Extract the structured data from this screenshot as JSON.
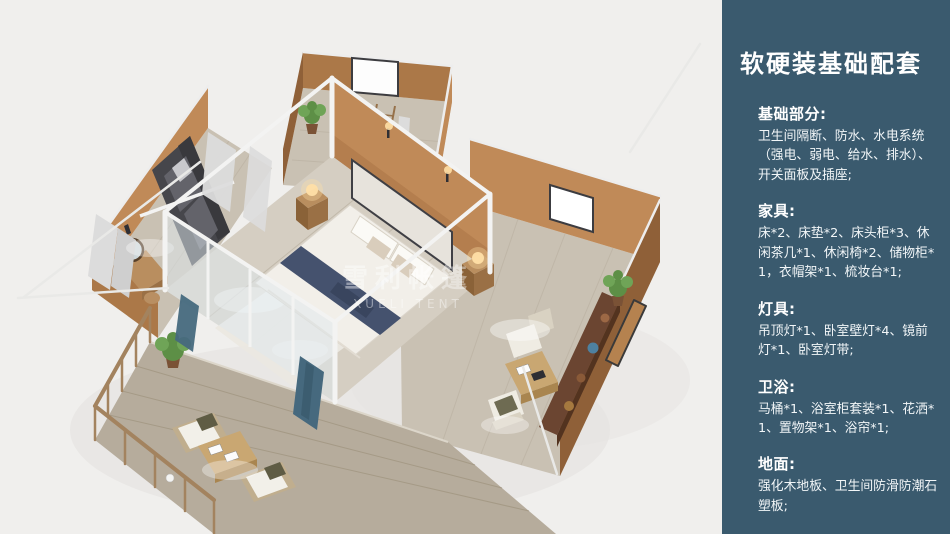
{
  "theme": {
    "canvas_bg": "#f0efed",
    "panel_bg": "#3a5a6e",
    "wall_lit": "#c08a58",
    "wall_mid": "#ab7848",
    "wall_dark": "#8f6038",
    "floor_wood": "#d5cec2",
    "floor_gray": "#c9c1b3",
    "deck_wood": "#b6ac9c",
    "rail_wood": "#a3835f",
    "frame_white": "#f3f3f2",
    "glass": "#dfe9ef",
    "bed_navy": "#45526e",
    "sofa_dark": "#46464b",
    "furn_wood": "#b98e5f",
    "sideboard": "#6b4531",
    "plant_green": "#5d8f46",
    "plant_green2": "#6fa457",
    "lamp_glow": "#ffdfa6",
    "curtain": "#dcdcdc",
    "blue_curtain": "#46697e"
  },
  "watermark": {
    "cn": "雪利帐篷",
    "en": "XUELI TENT"
  },
  "panel": {
    "title": "软硬装基础配套",
    "sections": [
      {
        "heading": "基础部分:",
        "body": "卫生间隔断、防水、水电系统（强电、弱电、给水、排水）、开关面板及插座;"
      },
      {
        "heading": "家具:",
        "body": "床*2、床垫*2、床头柜*3、休闲茶几*1、休闲椅*2、储物柜*1，衣帽架*1、梳妆台*1;"
      },
      {
        "heading": "灯具:",
        "body": "吊顶灯*1、卧室壁灯*4、镜前灯*1、卧室灯带;"
      },
      {
        "heading": "卫浴:",
        "body": "马桶*1、浴室柜套装*1、花洒*1、置物架*1、浴帘*1;"
      },
      {
        "heading": "地面:",
        "body": "强化木地板、卫生间防滑防潮石塑板;"
      }
    ]
  }
}
